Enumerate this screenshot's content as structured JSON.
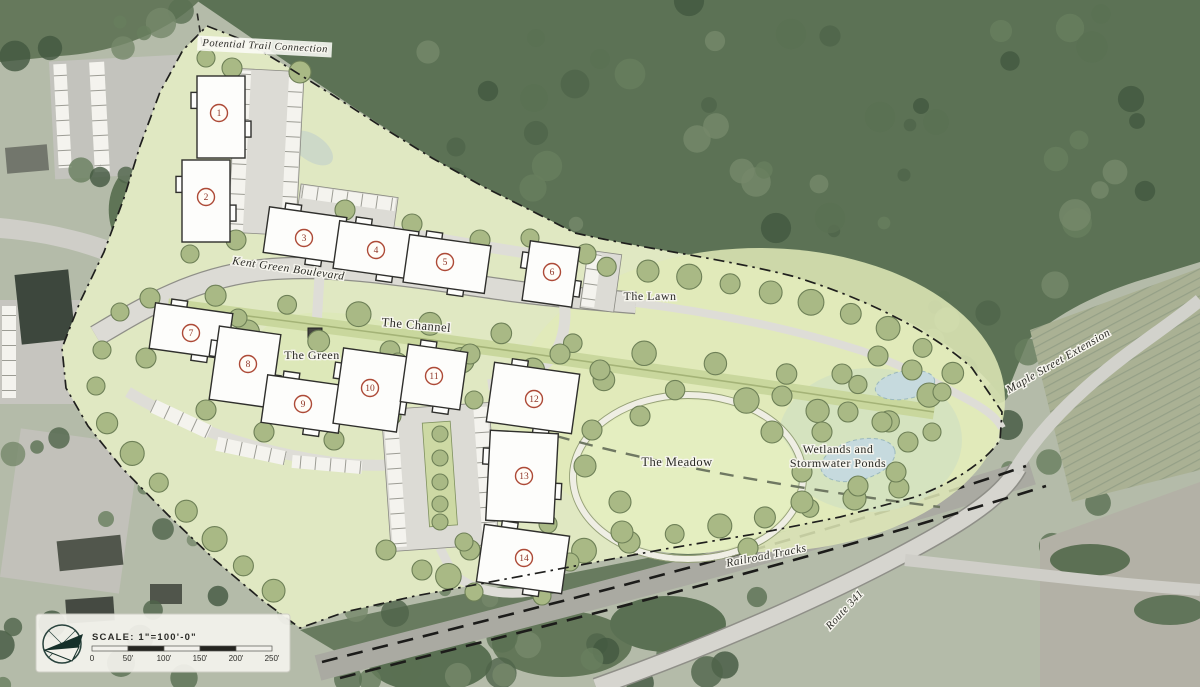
{
  "map": {
    "kind": "illustrative-site-plan-over-aerial",
    "labels": [
      {
        "name": "potential-trail-connection",
        "text": "Potential Trail Connection",
        "x": 265,
        "y": 49,
        "rotate": 3,
        "size": 10.5,
        "italic": true,
        "boxed": true
      },
      {
        "name": "kent-green-boulevard",
        "text": "Kent Green Boulevard",
        "x": 288,
        "y": 272,
        "rotate": 8,
        "size": 11.5,
        "italic": true
      },
      {
        "name": "the-channel",
        "text": "The Channel",
        "x": 416,
        "y": 329,
        "rotate": 5,
        "size": 12.5
      },
      {
        "name": "the-green",
        "text": "The Green",
        "x": 312,
        "y": 359,
        "rotate": 0,
        "size": 12
      },
      {
        "name": "the-lawn",
        "text": "The Lawn",
        "x": 650,
        "y": 300,
        "rotate": 0,
        "size": 12
      },
      {
        "name": "the-meadow",
        "text": "The Meadow",
        "x": 677,
        "y": 466,
        "rotate": 0,
        "size": 12.5
      },
      {
        "name": "wetlands-and-stormwater-ponds",
        "lines": [
          "Wetlands and",
          "Stormwater Ponds"
        ],
        "x": 838,
        "y": 453,
        "rotate": 0,
        "size": 12
      },
      {
        "name": "railroad-tracks",
        "text": "Railroad Tracks",
        "x": 767,
        "y": 559,
        "rotate": -11,
        "size": 11.5,
        "italic": true
      },
      {
        "name": "route-341",
        "text": "Route 341",
        "x": 847,
        "y": 612,
        "rotate": -47,
        "size": 11,
        "italic": true
      },
      {
        "name": "maple-street-extension",
        "text": "Maple Street Extension",
        "x": 1060,
        "y": 364,
        "rotate": -30,
        "size": 11.5,
        "italic": true
      }
    ],
    "building_markers": [
      {
        "number": "1",
        "x": 219,
        "y": 113
      },
      {
        "number": "2",
        "x": 206,
        "y": 197
      },
      {
        "number": "3",
        "x": 304,
        "y": 238
      },
      {
        "number": "4",
        "x": 376,
        "y": 250
      },
      {
        "number": "5",
        "x": 445,
        "y": 262
      },
      {
        "number": "6",
        "x": 552,
        "y": 272
      },
      {
        "number": "7",
        "x": 191,
        "y": 333
      },
      {
        "number": "8",
        "x": 248,
        "y": 364
      },
      {
        "number": "9",
        "x": 303,
        "y": 404
      },
      {
        "number": "10",
        "x": 370,
        "y": 388
      },
      {
        "number": "11",
        "x": 434,
        "y": 376
      },
      {
        "number": "12",
        "x": 534,
        "y": 399
      },
      {
        "number": "13",
        "x": 524,
        "y": 476
      },
      {
        "number": "14",
        "x": 524,
        "y": 558
      }
    ],
    "scale_bar": {
      "label": "SCALE: 1\"=100'-0\"",
      "ticks": [
        "0",
        "50'",
        "100'",
        "150'",
        "200'",
        "250'"
      ]
    },
    "colors": {
      "site_green": "#e0e8c2",
      "tree_olive": "#a9b985",
      "tree_edge": "#6e8057",
      "forest_dark": "#5c7255",
      "road_gray": "#dcdbd5",
      "pond_blue": "#c6dade",
      "marker_red": "#ad4a37",
      "marker_num": "#8e3425",
      "boundary": "#1f1f1d",
      "scale_dark": "#24241f",
      "scale_light": "#f2f1ec"
    }
  }
}
